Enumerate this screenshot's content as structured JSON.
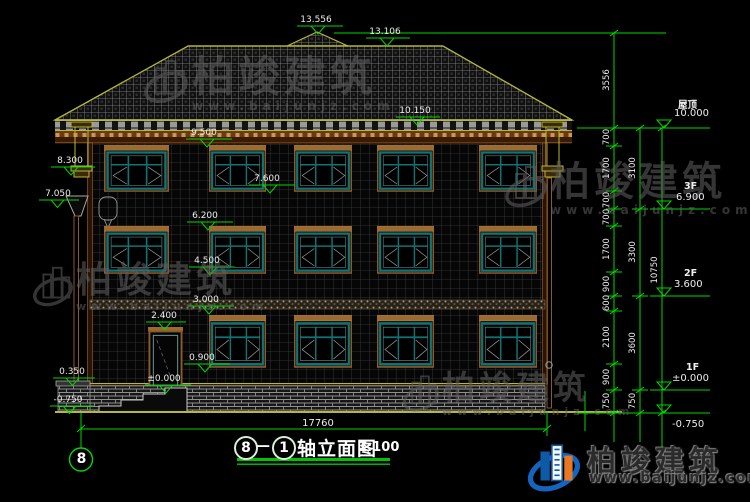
{
  "watermark": {
    "brand": "柏竣建筑",
    "url": "www.baijunjz.com"
  },
  "footer_logo": {
    "brand": "柏竣建筑",
    "url": "www.baijunjz.com"
  },
  "title": {
    "axis_from": "8",
    "dash": "—",
    "axis_to": "1",
    "name": "轴立面图",
    "scale": "1:100"
  },
  "axis_bubbles": {
    "bottom_left": "8"
  },
  "elevation_labels": {
    "peak": "13.556",
    "ridge": "13.106",
    "eave": "10.150",
    "f3_head": "9.500",
    "f3_sill": "7.600",
    "f2_head": "6.200",
    "f2_sill": "4.500",
    "f1_head": "3.000",
    "door_head": "2.400",
    "f1_sill": "0.900",
    "ground_zero": "±0.000",
    "left_capital": "8.300",
    "left_funnel": "7.050",
    "left_ledge": "0.350",
    "left_ground": "-0.750"
  },
  "right_levels": [
    {
      "name": "屋顶",
      "value": "10.000"
    },
    {
      "name": "3F",
      "value": "6.900"
    },
    {
      "name": "2F",
      "value": "3.600"
    },
    {
      "name": "1F",
      "value": "±0.000"
    },
    {
      "name": "",
      "value": "-0.750"
    }
  ],
  "dim_chains": {
    "inner": [
      "3556",
      "700",
      "1700",
      "700",
      "700",
      "1700",
      "900",
      "600",
      "2100",
      "900",
      "750"
    ],
    "middle": [
      "3100",
      "3300",
      "3600",
      "750"
    ],
    "overall_height": "10750",
    "overall_width": "17760"
  }
}
